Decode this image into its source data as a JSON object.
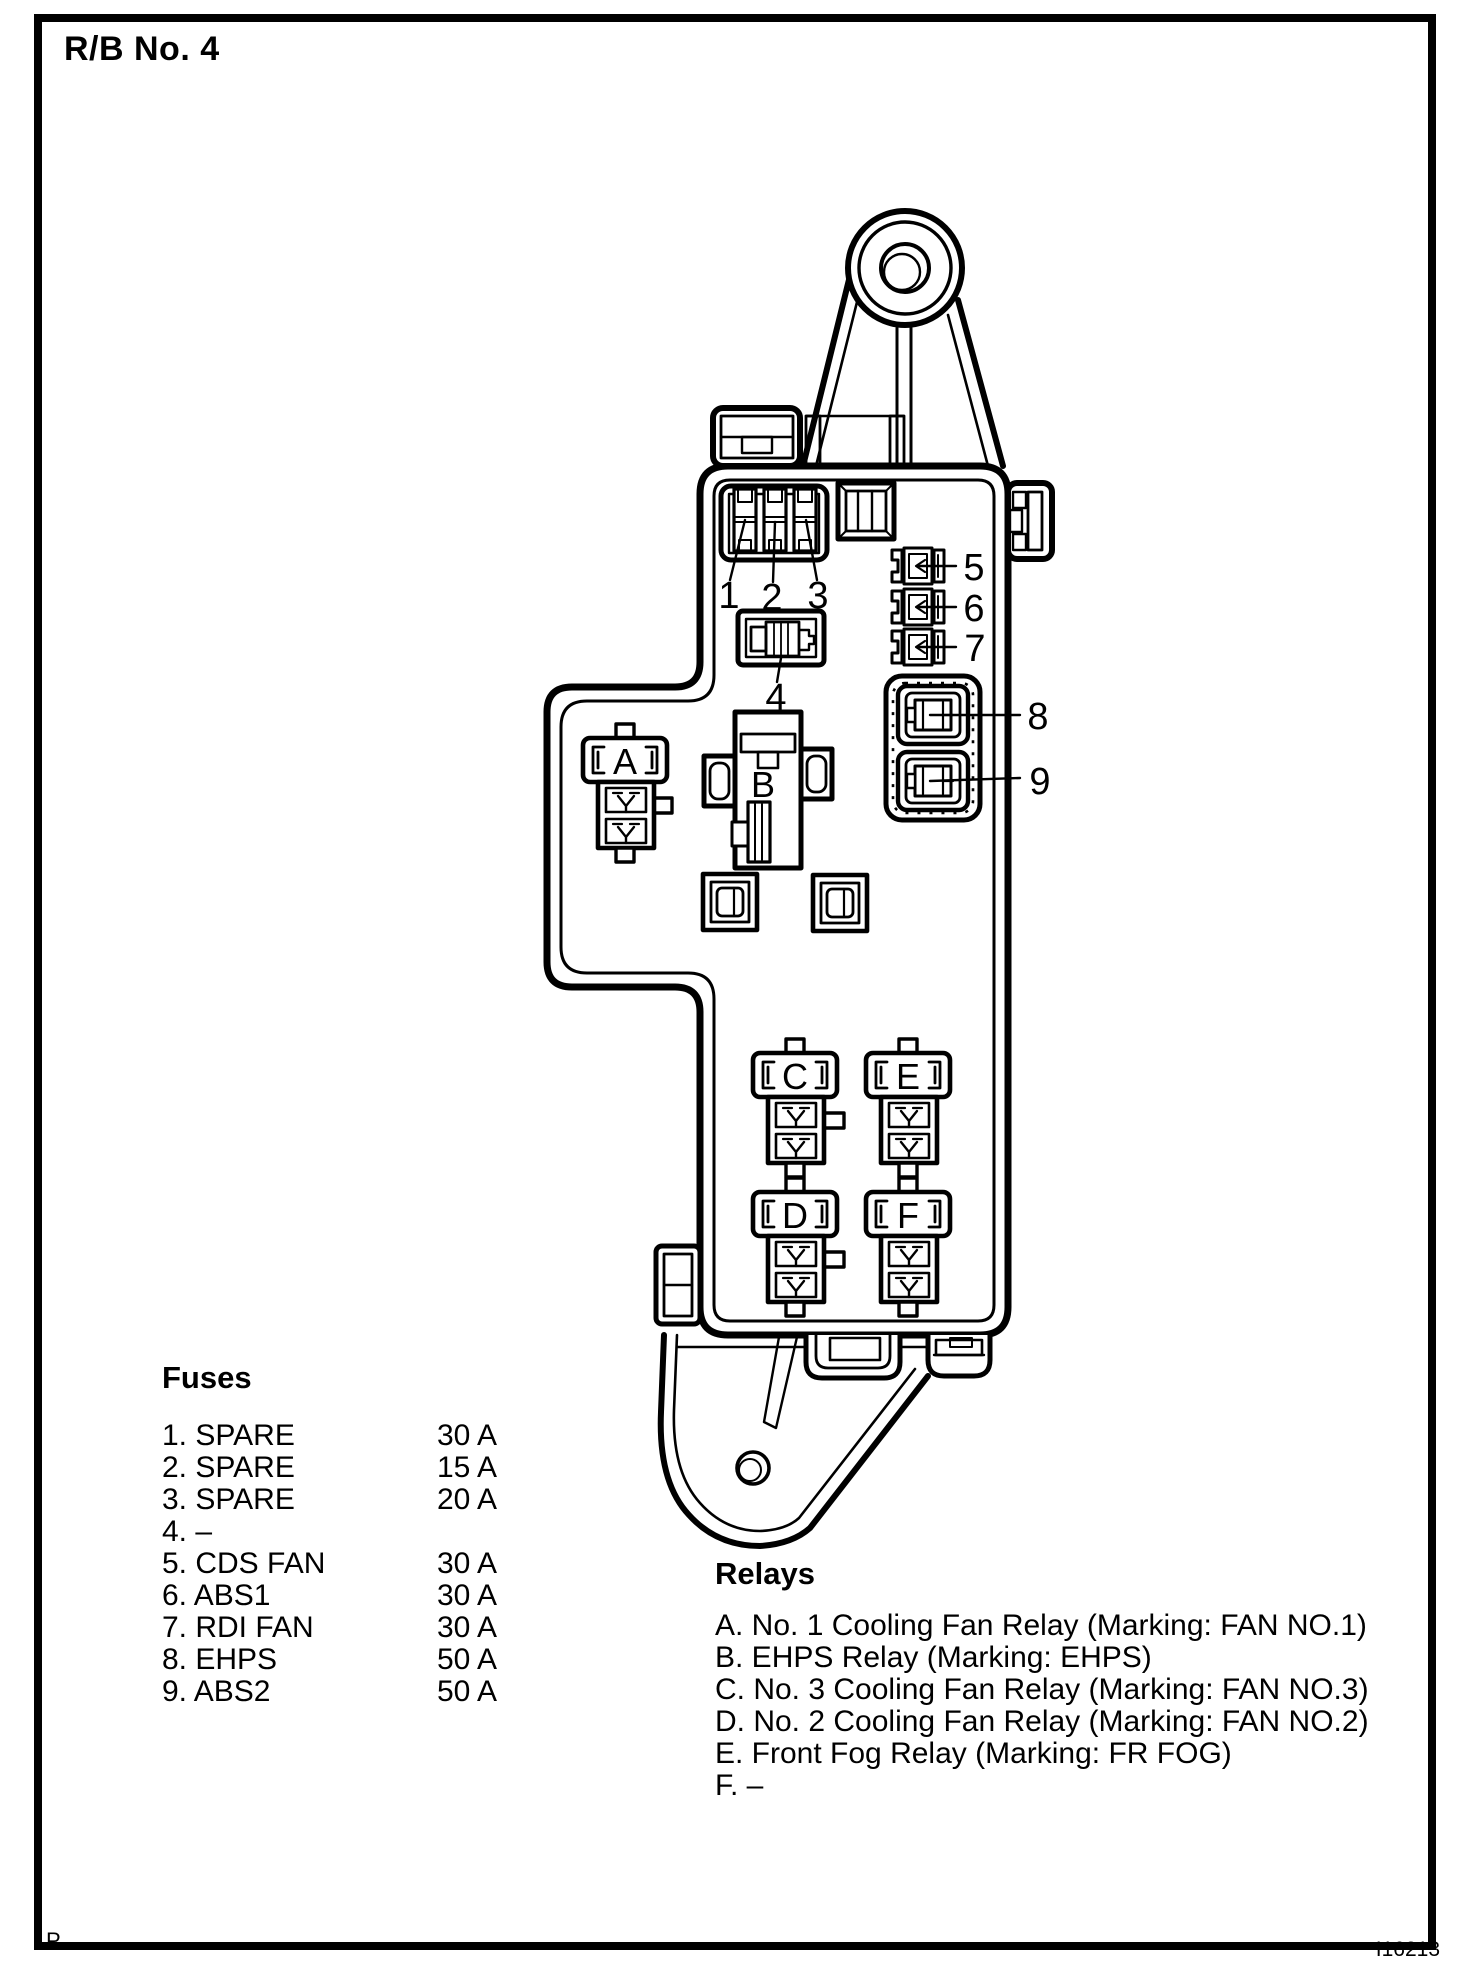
{
  "page": {
    "title": "R/B No. 4",
    "page_marker": "P",
    "figure_code": "I16213"
  },
  "diagram": {
    "fuse_callouts": [
      "1",
      "2",
      "3",
      "4",
      "5",
      "6",
      "7",
      "8",
      "9"
    ],
    "relay_callouts": [
      "A",
      "B",
      "C",
      "D",
      "E",
      "F"
    ]
  },
  "fuses_legend": {
    "heading": "Fuses",
    "items": [
      {
        "label": "1. SPARE",
        "amps": "30 A"
      },
      {
        "label": "2. SPARE",
        "amps": "15 A"
      },
      {
        "label": "3. SPARE",
        "amps": "20 A"
      },
      {
        "label": "4. –",
        "amps": ""
      },
      {
        "label": "5. CDS FAN",
        "amps": "30 A"
      },
      {
        "label": "6. ABS1",
        "amps": "30 A"
      },
      {
        "label": "7. RDI FAN",
        "amps": "30 A"
      },
      {
        "label": "8. EHPS",
        "amps": "50 A"
      },
      {
        "label": "9. ABS2",
        "amps": "50 A"
      }
    ]
  },
  "relays_legend": {
    "heading": "Relays",
    "items": [
      "A. No. 1 Cooling Fan Relay (Marking: FAN NO.1)",
      "B. EHPS Relay (Marking: EHPS)",
      "C. No. 3 Cooling Fan Relay (Marking: FAN NO.3)",
      "D. No. 2 Cooling Fan Relay (Marking: FAN NO.2)",
      "E. Front Fog Relay (Marking: FR FOG)",
      "F. –"
    ]
  }
}
